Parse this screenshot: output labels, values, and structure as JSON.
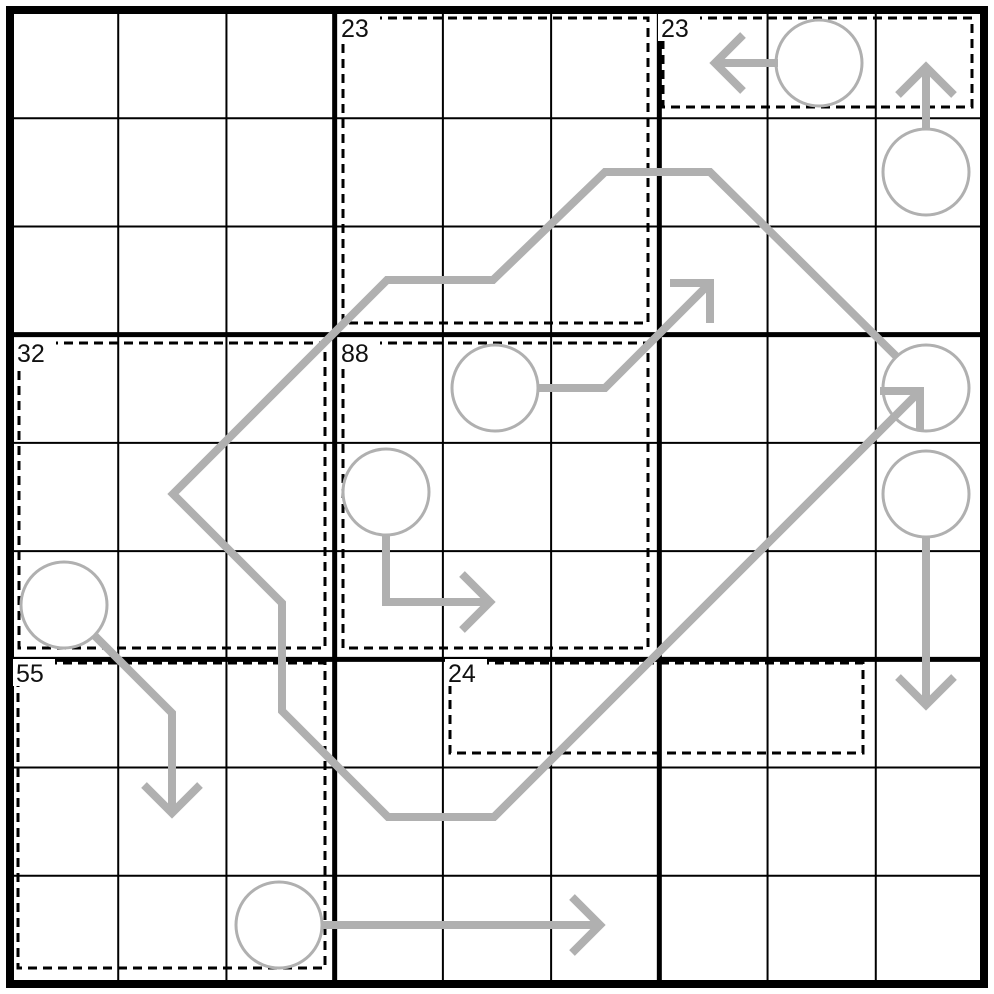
{
  "canvas": {
    "width": 994,
    "height": 994,
    "background": "#ffffff"
  },
  "grid": {
    "origin": 10,
    "size": 974,
    "cells": 9,
    "outer_width": 8,
    "box_width": 5,
    "thin_width": 2,
    "line_color": "#000000"
  },
  "cage_style": {
    "color": "#000000",
    "width": 3,
    "dash": "9 6",
    "label_size": 25,
    "label_color": "#111111",
    "label_bg": "#ffffff"
  },
  "line_style": {
    "color": "#b0b0b0",
    "width": 8
  },
  "circle_style": {
    "radius": 43,
    "stroke": "#b0b0b0",
    "width": 3,
    "fill": "#ffffff"
  },
  "cages": [
    {
      "label": "23",
      "x": 343,
      "y": 18,
      "w": 305,
      "h": 305
    },
    {
      "label": "23",
      "x": 663,
      "y": 18,
      "w": 309,
      "h": 89
    },
    {
      "label": "32",
      "x": 19,
      "y": 343,
      "w": 306,
      "h": 305
    },
    {
      "label": "88",
      "x": 343,
      "y": 343,
      "w": 305,
      "h": 305
    },
    {
      "label": "55",
      "x": 18,
      "y": 663,
      "w": 307,
      "h": 305
    },
    {
      "label": "24",
      "x": 450,
      "y": 663,
      "w": 413,
      "h": 90
    }
  ],
  "loop_path": {
    "points": [
      [
        897,
        357
      ],
      [
        710,
        172
      ],
      [
        605,
        172
      ],
      [
        493,
        280
      ],
      [
        387,
        280
      ],
      [
        173,
        494
      ],
      [
        282,
        603
      ],
      [
        282,
        711
      ],
      [
        388,
        817
      ],
      [
        494,
        817
      ],
      [
        920,
        391
      ]
    ]
  },
  "circles": [
    {
      "cell": "r1c8",
      "cx": 819,
      "cy": 63
    },
    {
      "cell": "r2c9",
      "cx": 926,
      "cy": 172
    },
    {
      "cell": "r4c9",
      "cx": 926,
      "cy": 388
    },
    {
      "cell": "r5c9",
      "cx": 926,
      "cy": 494
    },
    {
      "cell": "r4c5",
      "cx": 495,
      "cy": 388
    },
    {
      "cell": "r5c4",
      "cx": 386,
      "cy": 492
    },
    {
      "cell": "r6c1",
      "cx": 64,
      "cy": 605
    },
    {
      "cell": "r9c3",
      "cx": 279,
      "cy": 925
    }
  ],
  "arrows": [
    {
      "name": "loop-arrowhead",
      "shaft": [
        [
          494,
          817
        ],
        [
          920,
          391
        ]
      ],
      "head": [
        [
          880,
          391
        ],
        [
          920,
          391
        ],
        [
          920,
          431
        ]
      ]
    },
    {
      "name": "arrow-r4c5-ne",
      "shaft": [
        [
          538,
          388
        ],
        [
          605,
          388
        ],
        [
          710,
          283
        ]
      ],
      "head": [
        [
          670,
          283
        ],
        [
          710,
          283
        ],
        [
          710,
          323
        ]
      ]
    },
    {
      "name": "arrow-r5c4-right",
      "shaft": [
        [
          386,
          535
        ],
        [
          386,
          602
        ],
        [
          490,
          602
        ]
      ],
      "head": [
        [
          462,
          574
        ],
        [
          490,
          602
        ],
        [
          462,
          630
        ]
      ]
    },
    {
      "name": "arrow-r6c1-down",
      "shaft": [
        [
          94,
          635
        ],
        [
          172,
          713
        ],
        [
          172,
          813
        ]
      ],
      "head": [
        [
          144,
          785
        ],
        [
          172,
          813
        ],
        [
          200,
          785
        ]
      ]
    },
    {
      "name": "arrow-r2c9-up",
      "shaft": [
        [
          926,
          130
        ],
        [
          926,
          67
        ]
      ],
      "head": [
        [
          898,
          95
        ],
        [
          926,
          67
        ],
        [
          954,
          95
        ]
      ]
    },
    {
      "name": "arrow-r1c8-left",
      "shaft": [
        [
          778,
          63
        ],
        [
          715,
          63
        ]
      ],
      "head": [
        [
          743,
          35
        ],
        [
          715,
          63
        ],
        [
          743,
          91
        ]
      ]
    },
    {
      "name": "arrow-r5c9-down",
      "shaft": [
        [
          926,
          537
        ],
        [
          926,
          705
        ]
      ],
      "head": [
        [
          898,
          677
        ],
        [
          926,
          705
        ],
        [
          954,
          677
        ]
      ]
    },
    {
      "name": "arrow-r9c3-right",
      "shaft": [
        [
          322,
          925
        ],
        [
          600,
          925
        ]
      ],
      "head": [
        [
          572,
          897
        ],
        [
          600,
          925
        ],
        [
          572,
          953
        ]
      ]
    }
  ]
}
